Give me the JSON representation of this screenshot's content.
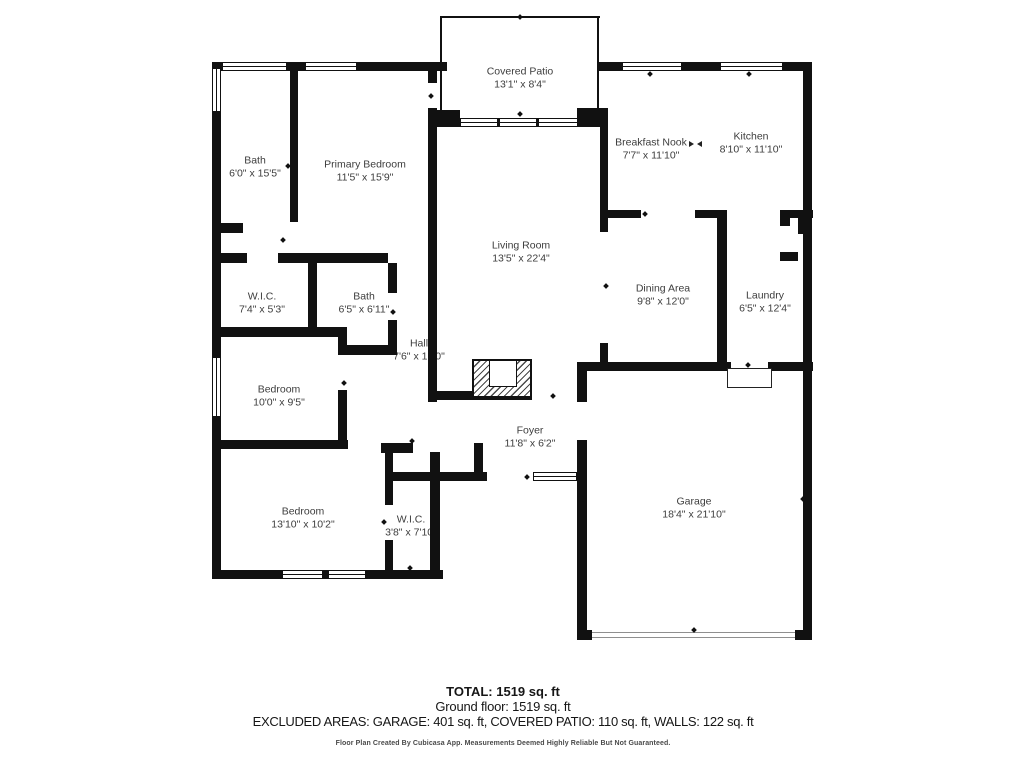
{
  "plan": {
    "rooms": [
      {
        "name": "Covered Patio",
        "dims": "13'1\" x 8'4\""
      },
      {
        "name": "Bath",
        "dims": "6'0\" x 15'5\""
      },
      {
        "name": "Primary Bedroom",
        "dims": "11'5\" x 15'9\""
      },
      {
        "name": "Breakfast Nook",
        "dims": "7'7\" x 11'10\""
      },
      {
        "name": "Kitchen",
        "dims": "8'10\" x 11'10\""
      },
      {
        "name": "Living Room",
        "dims": "13'5\" x 22'4\""
      },
      {
        "name": "Dining Area",
        "dims": "9'8\" x 12'0\""
      },
      {
        "name": "Laundry",
        "dims": "6'5\" x 12'4\""
      },
      {
        "name": "W.I.C.",
        "dims": "7'4\" x 5'3\""
      },
      {
        "name": "Bath",
        "dims": "6'5\" x 6'11\""
      },
      {
        "name": "Hall",
        "dims": "7'6\" x 15'0\""
      },
      {
        "name": "Bedroom",
        "dims": "10'0\" x 9'5\""
      },
      {
        "name": "Bedroom",
        "dims": "13'10\" x 10'2\""
      },
      {
        "name": "W.I.C.",
        "dims": "3'8\" x 7'10\""
      },
      {
        "name": "Foyer",
        "dims": "11'8\" x 6'2\""
      },
      {
        "name": "Garage",
        "dims": "18'4\" x 21'10\""
      }
    ]
  },
  "footer": {
    "total": "TOTAL: 1519 sq. ft",
    "ground_floor": "Ground floor: 1519 sq. ft",
    "excluded": "EXCLUDED AREAS: GARAGE: 401 sq. ft, COVERED PATIO: 110 sq. ft, WALLS: 122 sq. ft",
    "disclaimer": "Floor Plan Created By Cubicasa App. Measurements Deemed Highly Reliable But Not Guaranteed."
  },
  "colors": {
    "wall": "#111111",
    "room_label": "#3d3d3d",
    "footer_text": "#161616",
    "disclaimer_text": "#4a4a4a"
  }
}
